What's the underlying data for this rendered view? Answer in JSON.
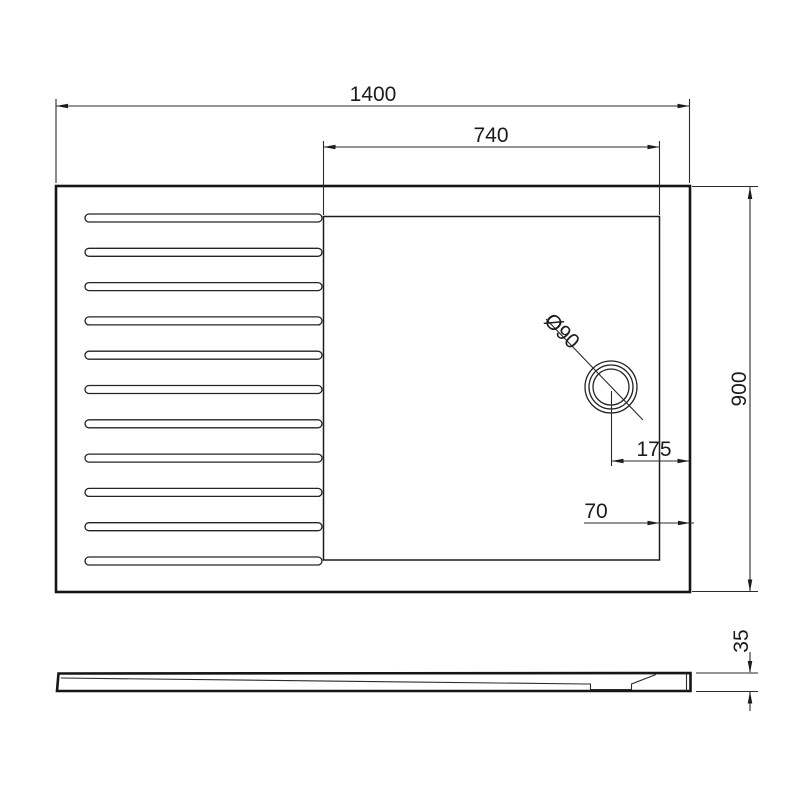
{
  "drawing": {
    "background": "#ffffff",
    "line_color": "#1c1c1c",
    "labels": {
      "overall_width": "1400",
      "shower_area_width": "740",
      "overall_depth": "900",
      "drain_diameter": "Ø90",
      "drain_offset_right": "175",
      "ledge_width": "70",
      "tray_thickness": "35"
    }
  }
}
